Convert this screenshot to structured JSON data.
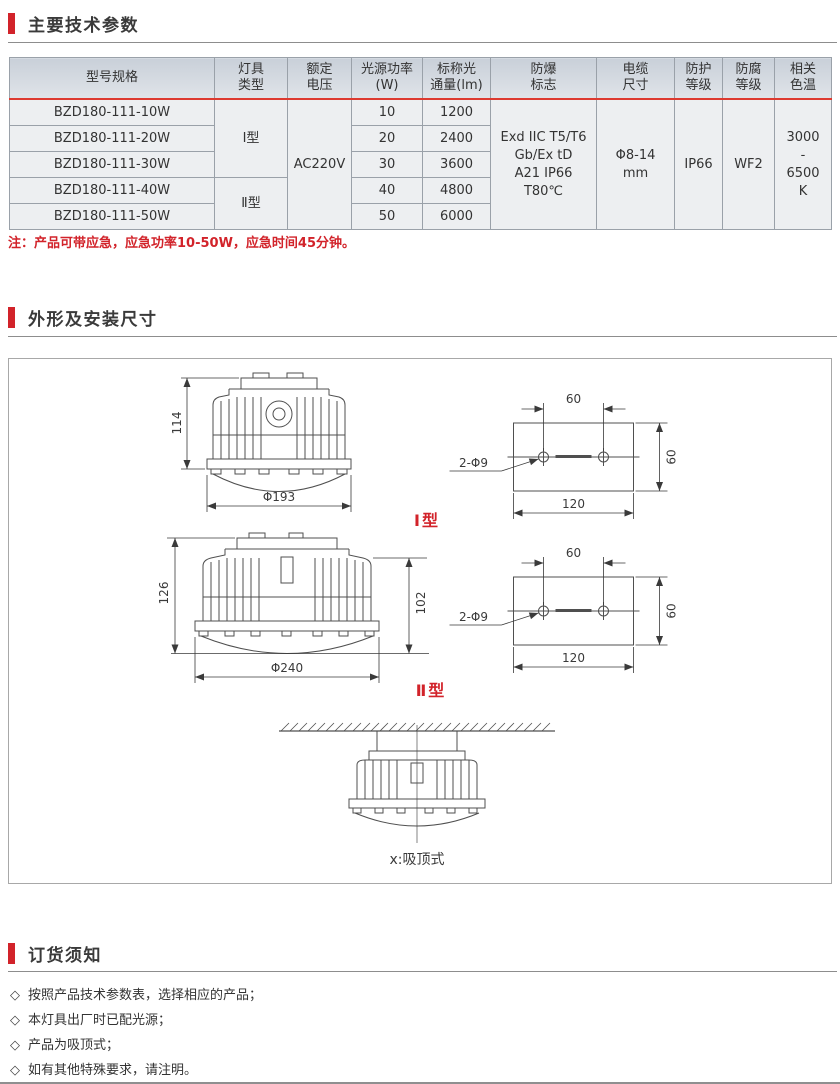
{
  "sections": {
    "tech": {
      "title": "主要技术参数"
    },
    "dims": {
      "title": "外形及安装尺寸"
    },
    "order": {
      "title": "订货须知"
    }
  },
  "table": {
    "headers": [
      "型号规格",
      "灯具\n类型",
      "额定\n电压",
      "光源功率\n(W)",
      "标称光\n通量(lm)",
      "防爆\n标志",
      "电缆\n尺寸",
      "防护\n等级",
      "防腐\n等级",
      "相关\n色温"
    ],
    "rows": [
      {
        "model": "BZD180-111-10W",
        "power": "10",
        "flux": "1200"
      },
      {
        "model": "BZD180-111-20W",
        "power": "20",
        "flux": "2400"
      },
      {
        "model": "BZD180-111-30W",
        "power": "30",
        "flux": "3600"
      },
      {
        "model": "BZD180-111-40W",
        "power": "40",
        "flux": "4800"
      },
      {
        "model": "BZD180-111-50W",
        "power": "50",
        "flux": "6000"
      }
    ],
    "type_groups": [
      {
        "label": "Ⅰ型",
        "span": 3
      },
      {
        "label": "Ⅱ型",
        "span": 2
      }
    ],
    "voltage": "AC220V",
    "ex_mark": "Exd IIC T5/T6\nGb/Ex tD\nA21 IP66\nT80℃",
    "cable": "Φ8-14\nmm",
    "protection": "IP66",
    "anticorrosion": "WF2",
    "cct": "3000\n-\n6500\nK"
  },
  "note": "注：产品可带应急，应急功率10-50W，应急时间45分钟。",
  "drawings": {
    "type1_label": "Ⅰ型",
    "type2_label": "Ⅱ型",
    "lamp1": {
      "height": "114",
      "diameter": "Φ193"
    },
    "lamp2": {
      "height": "126",
      "body_height": "102",
      "diameter": "Φ240"
    },
    "plate": {
      "hole_spacing": "60",
      "plate_height": "60",
      "plate_width": "120",
      "holes": "2-Φ9"
    },
    "ceiling_caption": "x:吸顶式"
  },
  "ordering": {
    "bullet": "◇",
    "items": [
      "按照产品技术参数表，选择相应的产品；",
      "本灯具出厂时已配光源；",
      "产品为吸顶式；",
      "如有其他特殊要求，请注明。"
    ]
  },
  "colors": {
    "accent": "#d2232a"
  }
}
